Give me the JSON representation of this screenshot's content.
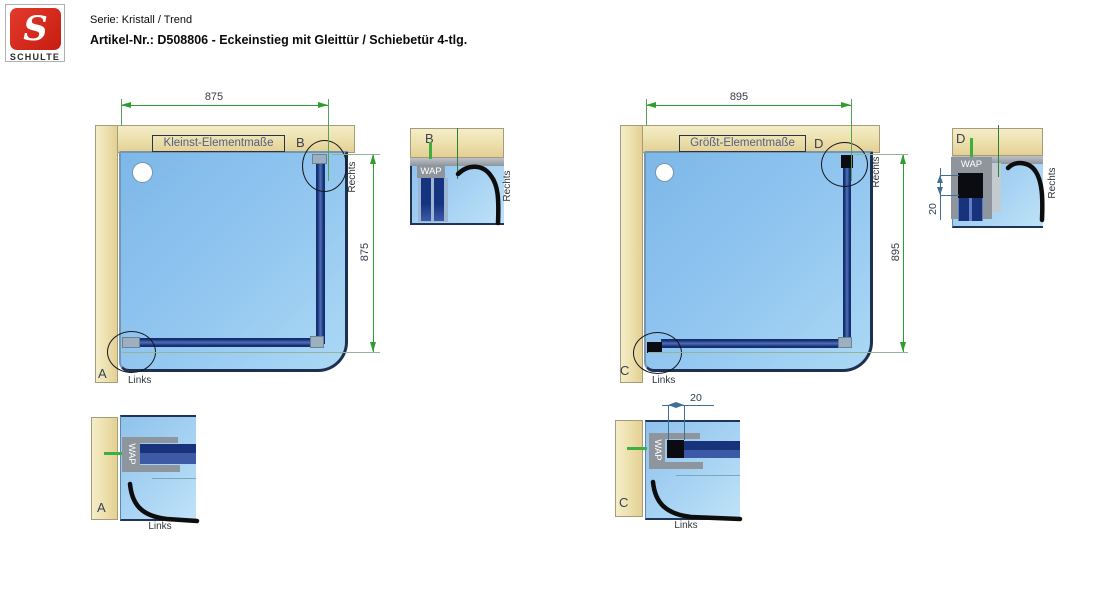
{
  "header": {
    "logo": {
      "letter": "S",
      "brand": "SCHULTE"
    },
    "series_line": "Serie: Kristall / Trend",
    "article_line": "Artikel-Nr.: D508806 - Eckeinstieg mit Gleittür / Schiebetür 4-tlg."
  },
  "diagrams": {
    "left": {
      "title": "Kleinst-Elementmaße",
      "dim_width": "875",
      "dim_height": "875",
      "corner_top_label": "B",
      "corner_bottom_label": "A",
      "left_label": "Links",
      "right_label": "Rechts"
    },
    "right": {
      "title": "Größt-Elementmaße",
      "dim_width": "895",
      "dim_height": "895",
      "corner_top_label": "D",
      "corner_bottom_label": "C",
      "left_label": "Links",
      "right_label": "Rechts"
    }
  },
  "details": {
    "a": {
      "label": "A",
      "profile_label": "WAP",
      "side_label": "Links"
    },
    "b": {
      "label": "B",
      "profile_label": "WAP",
      "side_label": "Rechts"
    },
    "c": {
      "label": "C",
      "profile_label": "WAP",
      "side_label": "Links",
      "gap_dim": "20"
    },
    "d": {
      "label": "D",
      "profile_label": "WAP",
      "side_label": "Rechts",
      "gap_dim": "20"
    }
  },
  "colors": {
    "wall_beige": "#ecdfab",
    "tray_blue": "#8fc4ef",
    "rail_navy": "#19327c",
    "dimension_green": "#2f9e2f",
    "detail_dim_blue": "#3f6f96",
    "profile_gray": "#8e959c",
    "logo_red": "#d6281c"
  }
}
